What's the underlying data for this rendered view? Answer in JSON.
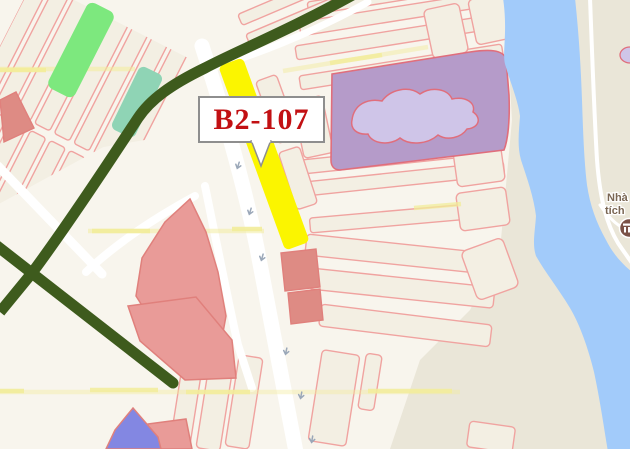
{
  "window": {
    "width": 630,
    "height": 449
  },
  "map": {
    "callout": {
      "text": "B2-107"
    },
    "poi_label": {
      "line1": "Nhà",
      "line2": "tích"
    },
    "colors": {
      "bank_bg": "#EAE6D8",
      "urban_bg": "#F8F5ED",
      "parcel_fill": "#F3EFE3",
      "parcel_stroke": "#F0A3A0",
      "road_white": "#FFFFFF",
      "road_yellow": "#F2EC9A",
      "road_green": "#3E5B1D",
      "water": "#A2CBFA",
      "parcel_yellow": "#FBF500",
      "parcel_green": "#7DE87E",
      "parcel_teal": "#8FD4B5",
      "parcel_violet": "#8387E2",
      "parcel_salmon": "#E99B98",
      "parcel_salmon_stroke": "#E0807C",
      "parcel_red": "#DE8B84",
      "area_purple": "#B59BC9",
      "area_purple_inner": "#CFC5E8",
      "area_purple_stroke": "#E06E7C",
      "callout_text": "#C21013",
      "callout_border": "#8E8E8E",
      "arrow": "#9AA7B8",
      "poi_text": "#7A6653",
      "poi_icon": "#7B5247"
    }
  }
}
